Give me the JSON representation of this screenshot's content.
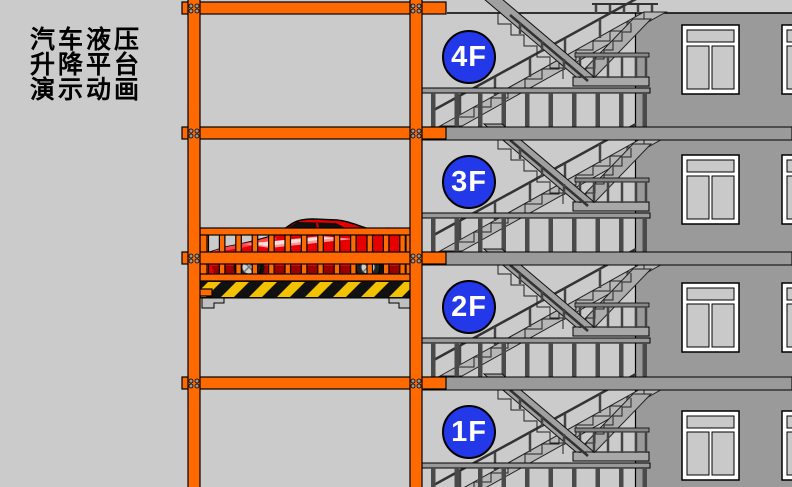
{
  "title": {
    "lines": [
      "汽车液压",
      "升降平台",
      "演示动画"
    ]
  },
  "floors": [
    {
      "label": "4F"
    },
    {
      "label": "3F"
    },
    {
      "label": "2F"
    },
    {
      "label": "1F"
    }
  ],
  "scene": {
    "description_icons": [
      "hydraulic-lift-frame",
      "red-sports-car",
      "hazard-stripe-platform",
      "stairwell",
      "building-windows"
    ]
  },
  "colors": {
    "background": "#CBCBCB",
    "wall": "#9A9A9A",
    "frame_orange": "#FF6A00",
    "badge_blue": "#2338E8",
    "car_red": "#E60000",
    "hazard_yellow": "#F2C200",
    "hazard_black": "#111111"
  }
}
